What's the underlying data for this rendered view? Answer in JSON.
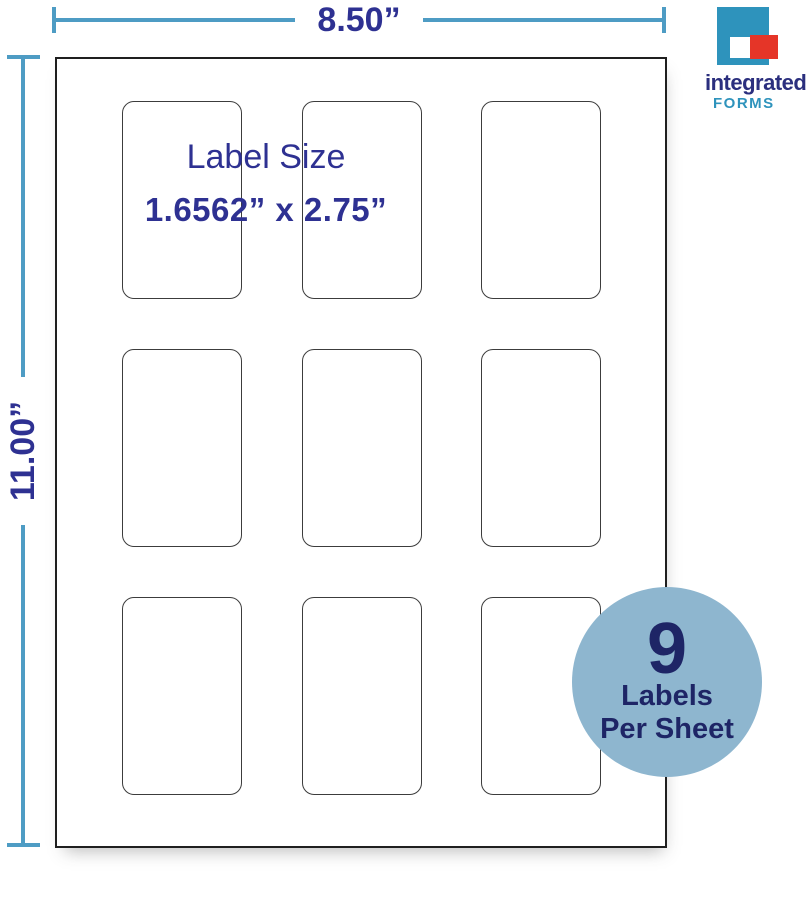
{
  "dimension_labels": {
    "width": "8.50”",
    "height": "11.00”"
  },
  "label_info": {
    "title": "Label Size",
    "size": "1.6562” x 2.75”"
  },
  "badge": {
    "count": "9",
    "line1": "Labels",
    "line2": "Per Sheet"
  },
  "logo": {
    "name": "integrated",
    "subname": "FORMS"
  },
  "sheet": {
    "rows": 3,
    "cols": 3,
    "labels_per_sheet": 9
  },
  "colors": {
    "dimension_line": "#4E9CC4",
    "dimension_text": "#2E3192",
    "badge_fill": "#8EB6CF",
    "badge_text": "#1E2566",
    "logo_teal": "#2E93BC",
    "logo_red": "#E53528",
    "logo_name_navy": "#2B2F7E",
    "sheet_border": "#1F1F1F",
    "label_border": "#3C3C3C"
  }
}
